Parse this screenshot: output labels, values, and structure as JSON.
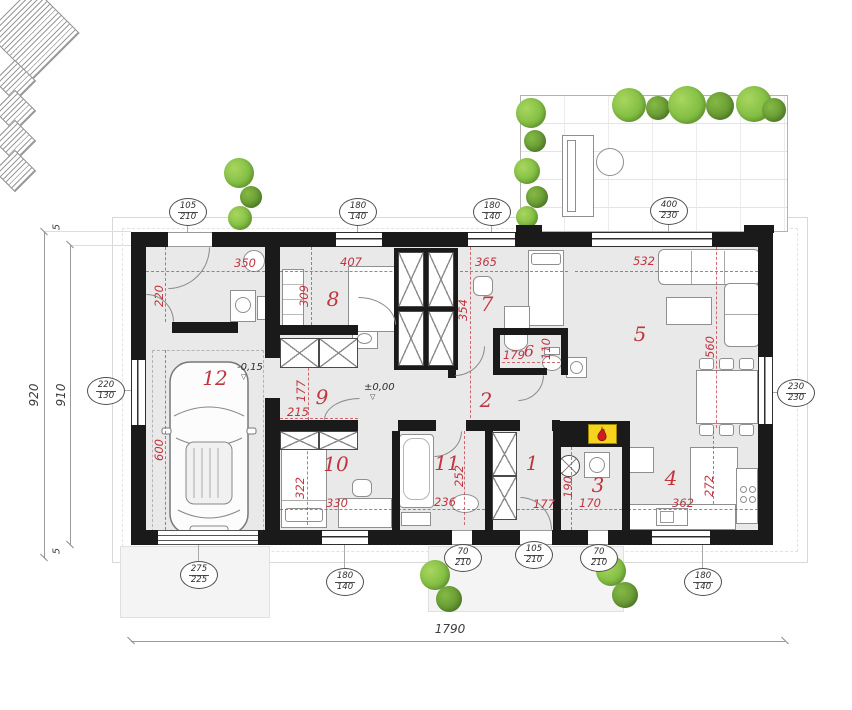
{
  "overall": {
    "width": "1790",
    "height_outer": "920",
    "height_inner": "910",
    "wall_top": "5",
    "wall_bottom": "5"
  },
  "levels": {
    "garage": "-0,15",
    "ground": "±0,00"
  },
  "rooms": [
    {
      "number": "1",
      "dims": [
        "177"
      ]
    },
    {
      "number": "2",
      "dims": []
    },
    {
      "number": "3",
      "dims": [
        "190",
        "170"
      ]
    },
    {
      "number": "4",
      "dims": [
        "362",
        "272"
      ]
    },
    {
      "number": "5",
      "dims": [
        "532",
        "560"
      ]
    },
    {
      "number": "6",
      "dims": [
        "179",
        "110"
      ]
    },
    {
      "number": "7",
      "dims": [
        "365",
        "354"
      ]
    },
    {
      "number": "8",
      "dims": [
        "407",
        "309"
      ]
    },
    {
      "number": "9",
      "dims": [
        "177",
        "215"
      ]
    },
    {
      "number": "10",
      "dims": [
        "322",
        "330"
      ]
    },
    {
      "number": "11",
      "dims": [
        "236",
        "252"
      ]
    },
    {
      "number": "12",
      "dims": [
        "350",
        "220",
        "600"
      ]
    }
  ],
  "openings": [
    {
      "w": "105",
      "h": "210"
    },
    {
      "w": "180",
      "h": "140"
    },
    {
      "w": "180",
      "h": "140"
    },
    {
      "w": "400",
      "h": "230"
    },
    {
      "w": "220",
      "h": "130"
    },
    {
      "w": "230",
      "h": "230"
    },
    {
      "w": "275",
      "h": "225"
    },
    {
      "w": "180",
      "h": "140"
    },
    {
      "w": "70",
      "h": "210"
    },
    {
      "w": "105",
      "h": "210"
    },
    {
      "w": "70",
      "h": "210"
    },
    {
      "w": "180",
      "h": "140"
    }
  ]
}
